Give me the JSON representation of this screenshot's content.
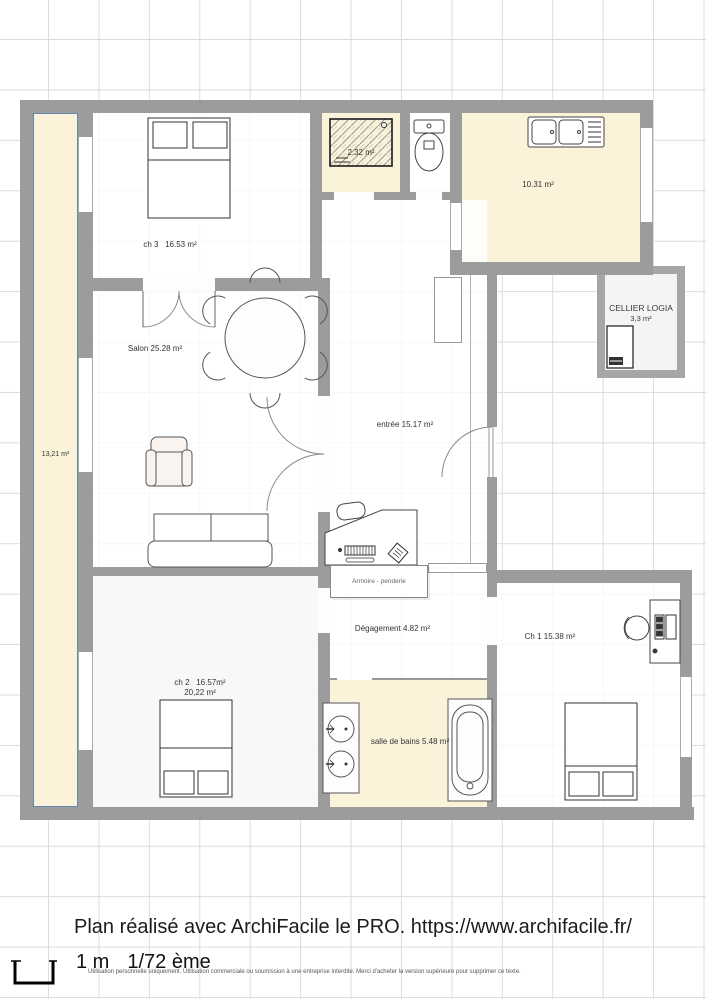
{
  "plan": {
    "rooms": {
      "ch3": {
        "label": "ch 3   16.53 m²"
      },
      "salon": {
        "label": "Salon 25.28 m²"
      },
      "entree": {
        "label": "entrée 15.17 m²"
      },
      "shower": {
        "label": "2.32 m²"
      },
      "kitchen": {
        "label": "10.31 m²"
      },
      "cellier": {
        "title": "CELLIER LOGIA",
        "area": "3,3 m²"
      },
      "balcony": {
        "label": "13,21 m²"
      },
      "ch2": {
        "label": "ch 2   16.57m²",
        "label2": "20,22 m²"
      },
      "degagement": {
        "label": "Dégagement 4.82 m²"
      },
      "salle_de_bains": {
        "label": "salle de bains 5.48 m²"
      },
      "ch1": {
        "label": "Ch 1 15.38 m²"
      },
      "armoire": {
        "label": "Armoire - penderie"
      }
    },
    "icons": [
      "double-bed-icon",
      "dining-table-icon",
      "chair-icon",
      "armchair-icon",
      "sofa-icon",
      "desk-icon",
      "office-chair-icon",
      "keyboard-icon",
      "toilet-icon",
      "kitchen-sink-icon",
      "shower-icon",
      "washbasin-icon",
      "bathtub-icon",
      "appliance-icon",
      "door-swing-icon",
      "scale-bracket-icon"
    ],
    "colors": {
      "wall": "#9c9c9c",
      "room_cream": "#faf3da",
      "balcony_outline": "#5d8aae",
      "grid": "#dcdcdc"
    }
  },
  "footer": {
    "credit": "Plan réalisé avec ArchiFacile le PRO. https://www.archifacile.fr/",
    "scale_value": "1 m",
    "scale_ratio": "1/72 ème",
    "license": "Utilisation personnelle uniquement. Utilisation commerciale ou soumission à une entreprise interdite. Merci d'acheter la version supérieure pour supprimer ce texte."
  }
}
